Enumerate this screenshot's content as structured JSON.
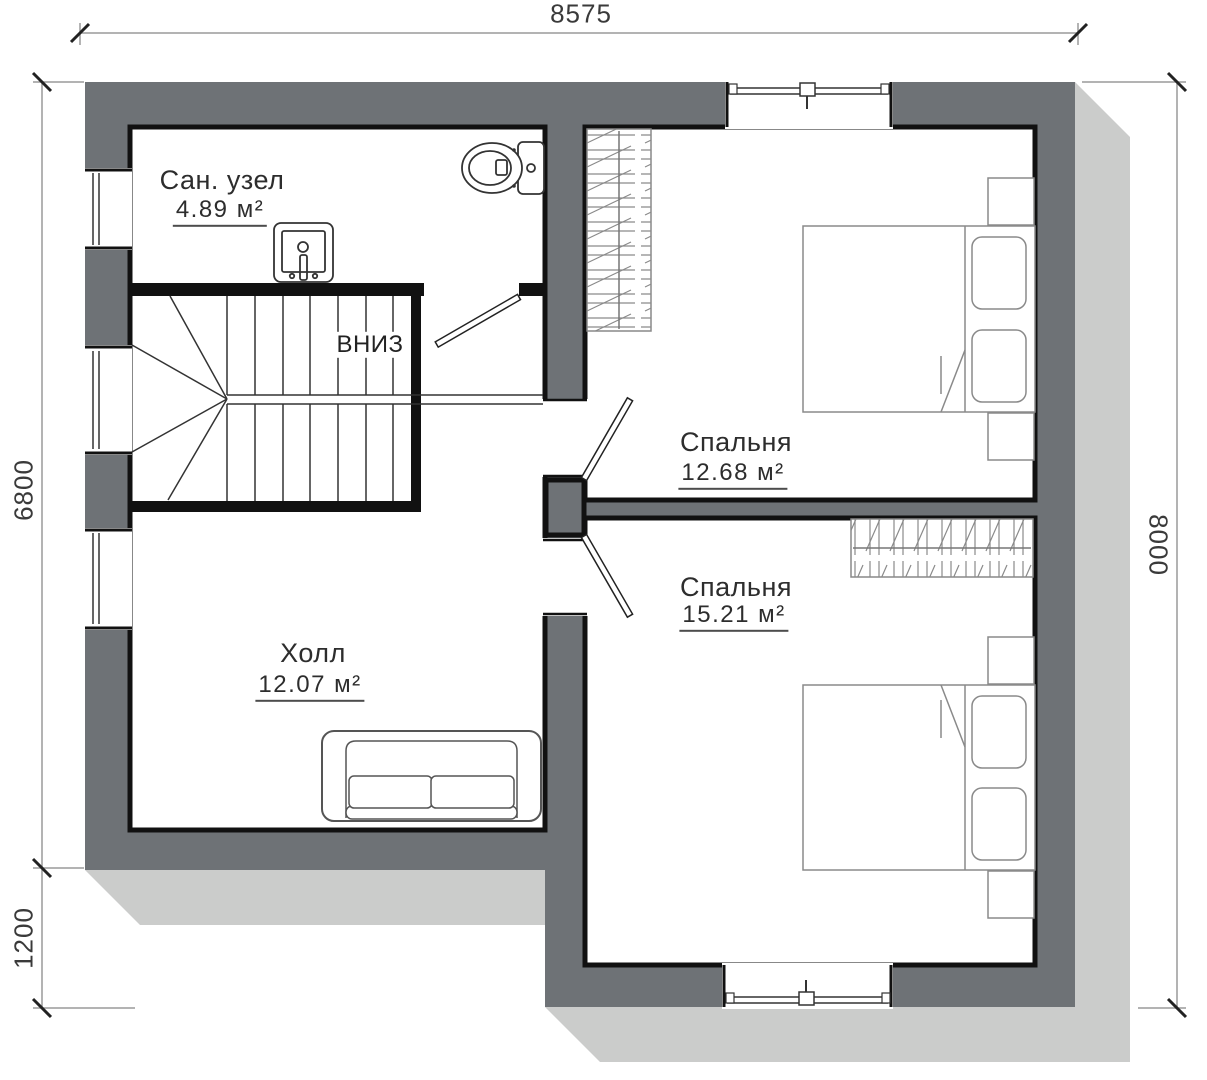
{
  "plan": {
    "dimensions": {
      "top": "8575",
      "left_upper": "6800",
      "left_lower": "1200",
      "right": "8000"
    },
    "rooms": [
      {
        "name": "Сан. узел",
        "area": "4.89 м²"
      },
      {
        "name": "Спальня",
        "area": "12.68 м²"
      },
      {
        "name": "Спальня",
        "area": "15.21 м²"
      },
      {
        "name": "Холл",
        "area": "12.07 м²"
      }
    ],
    "stairs_label": "ВНИЗ",
    "colors": {
      "wall": "#6e7276",
      "shadow": "#cbcccb",
      "line": "#111111"
    }
  }
}
